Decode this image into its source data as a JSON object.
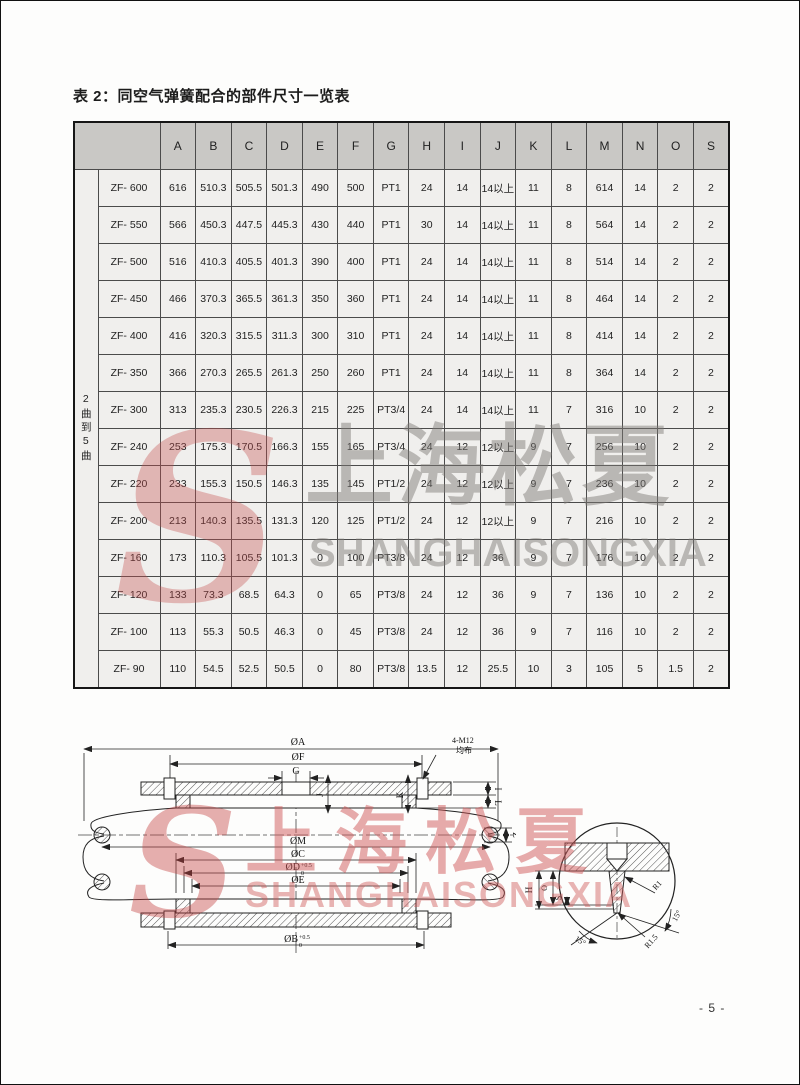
{
  "page": {
    "title": "表 2：同空气弹簧配合的部件尺寸一览表",
    "page_number": "- 5 -"
  },
  "colors": {
    "brand_red": "#c24b4b",
    "watermark_gray": "#8a8885",
    "header_gray": "#c9c8c5",
    "cell_gray": "#f0efed"
  },
  "watermark": {
    "logo_letter": "S",
    "cn": "上海松夏",
    "en": "SHANGHAISONGXIA"
  },
  "table": {
    "row_group_label": "2曲到5曲",
    "columns": [
      "A",
      "B",
      "C",
      "D",
      "E",
      "F",
      "G",
      "H",
      "I",
      "J",
      "K",
      "L",
      "M",
      "N",
      "O",
      "S"
    ],
    "rows": [
      {
        "model": "ZF- 600",
        "values": [
          "616",
          "510.3",
          "505.5",
          "501.3",
          "490",
          "500",
          "PT1",
          "24",
          "14",
          "14以上",
          "11",
          "8",
          "614",
          "14",
          "2",
          "2"
        ]
      },
      {
        "model": "ZF- 550",
        "values": [
          "566",
          "450.3",
          "447.5",
          "445.3",
          "430",
          "440",
          "PT1",
          "30",
          "14",
          "14以上",
          "11",
          "8",
          "564",
          "14",
          "2",
          "2"
        ]
      },
      {
        "model": "ZF- 500",
        "values": [
          "516",
          "410.3",
          "405.5",
          "401.3",
          "390",
          "400",
          "PT1",
          "24",
          "14",
          "14以上",
          "11",
          "8",
          "514",
          "14",
          "2",
          "2"
        ]
      },
      {
        "model": "ZF- 450",
        "values": [
          "466",
          "370.3",
          "365.5",
          "361.3",
          "350",
          "360",
          "PT1",
          "24",
          "14",
          "14以上",
          "11",
          "8",
          "464",
          "14",
          "2",
          "2"
        ]
      },
      {
        "model": "ZF- 400",
        "values": [
          "416",
          "320.3",
          "315.5",
          "311.3",
          "300",
          "310",
          "PT1",
          "24",
          "14",
          "14以上",
          "11",
          "8",
          "414",
          "14",
          "2",
          "2"
        ]
      },
      {
        "model": "ZF- 350",
        "values": [
          "366",
          "270.3",
          "265.5",
          "261.3",
          "250",
          "260",
          "PT1",
          "24",
          "14",
          "14以上",
          "11",
          "8",
          "364",
          "14",
          "2",
          "2"
        ]
      },
      {
        "model": "ZF- 300",
        "values": [
          "313",
          "235.3",
          "230.5",
          "226.3",
          "215",
          "225",
          "PT3/4",
          "24",
          "14",
          "14以上",
          "11",
          "7",
          "316",
          "10",
          "2",
          "2"
        ]
      },
      {
        "model": "ZF- 240",
        "values": [
          "253",
          "175.3",
          "170.5",
          "166.3",
          "155",
          "165",
          "PT3/4",
          "24",
          "12",
          "12以上",
          "9",
          "7",
          "256",
          "10",
          "2",
          "2"
        ]
      },
      {
        "model": "ZF- 220",
        "values": [
          "233",
          "155.3",
          "150.5",
          "146.3",
          "135",
          "145",
          "PT1/2",
          "24",
          "12",
          "12以上",
          "9",
          "7",
          "236",
          "10",
          "2",
          "2"
        ]
      },
      {
        "model": "ZF- 200",
        "values": [
          "213",
          "140.3",
          "135.5",
          "131.3",
          "120",
          "125",
          "PT1/2",
          "24",
          "12",
          "12以上",
          "9",
          "7",
          "216",
          "10",
          "2",
          "2"
        ]
      },
      {
        "model": "ZF- 160",
        "values": [
          "173",
          "110.3",
          "105.5",
          "101.3",
          "0",
          "100",
          "PT3/8",
          "24",
          "12",
          "36",
          "9",
          "7",
          "176",
          "10",
          "2",
          "2"
        ]
      },
      {
        "model": "ZF- 120",
        "values": [
          "133",
          "73.3",
          "68.5",
          "64.3",
          "0",
          "65",
          "PT3/8",
          "24",
          "12",
          "36",
          "9",
          "7",
          "136",
          "10",
          "2",
          "2"
        ]
      },
      {
        "model": "ZF- 100",
        "values": [
          "113",
          "55.3",
          "50.5",
          "46.3",
          "0",
          "45",
          "PT3/8",
          "24",
          "12",
          "36",
          "9",
          "7",
          "116",
          "10",
          "2",
          "2"
        ]
      },
      {
        "model": "ZF- 90",
        "values": [
          "110",
          "54.5",
          "52.5",
          "50.5",
          "0",
          "80",
          "PT3/8",
          "13.5",
          "12",
          "25.5",
          "10",
          "3",
          "105",
          "5",
          "1.5",
          "2"
        ]
      }
    ]
  },
  "diagram": {
    "main": {
      "dia_a": "ØA",
      "dia_f": "ØF",
      "g": "G",
      "bolt_note_1": "4-M12",
      "bolt_note_2": "均布",
      "dim_i": "I",
      "dim_l": "L",
      "dim_j": "J",
      "dim_k": "K",
      "dim_z": "Z",
      "dia_m": "ØM",
      "dia_c": "ØC",
      "dia_d": "ØD",
      "dia_d_sub": "0",
      "dia_d_sup": "+0.5",
      "dia_e": "ØE",
      "dia_b": "ØB",
      "dia_b_sub": "0",
      "dia_b_sup": "+0.5"
    },
    "detail": {
      "dim_h": "H",
      "dim_o": "O",
      "dim_s": "S",
      "r1": "R1",
      "r1_5": "R1.5",
      "angle_left": "15°",
      "angle_right": "15°"
    }
  }
}
